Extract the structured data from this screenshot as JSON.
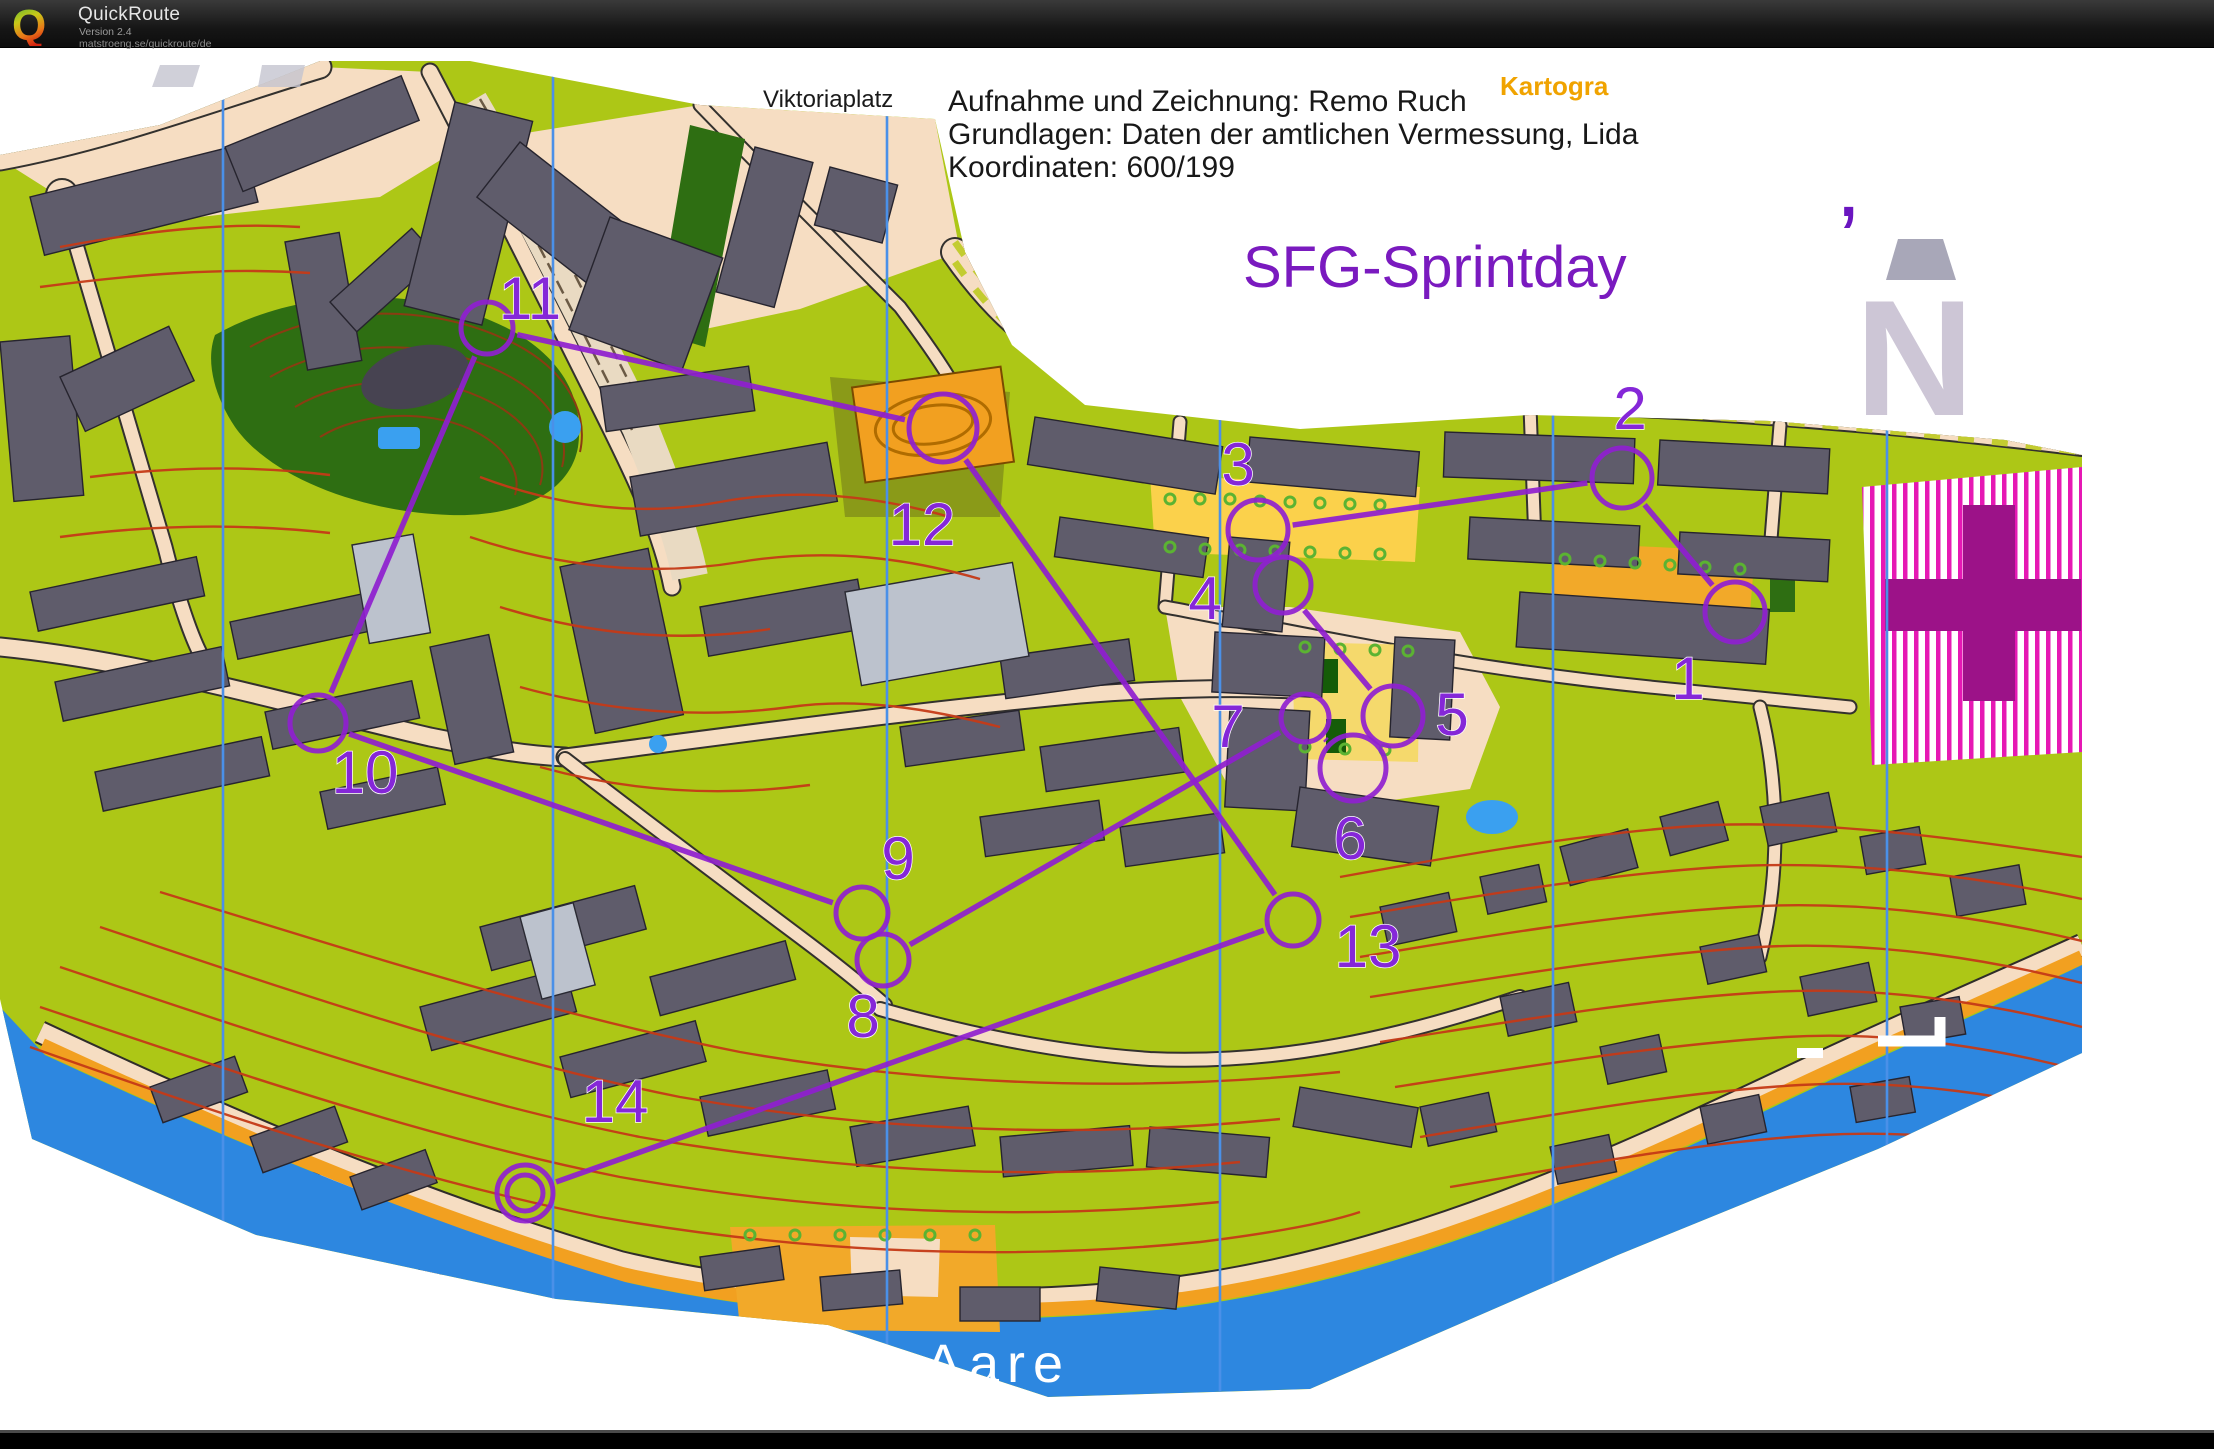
{
  "header": {
    "logo_letter": "Q",
    "app_name": "QuickRoute",
    "version": "Version 2.4",
    "url": "matstroeng.se/quickroute/de"
  },
  "map": {
    "labels": {
      "place": "Viktoriaplatz",
      "event_title": "SFG-Sprintday",
      "partial_text": "Kartogra",
      "river": "Aare",
      "north_mark": "N",
      "apostrophe": "’"
    },
    "credits": [
      "Aufnahme und Zeichnung: Remo Ruch",
      "Grundlagen: Daten der amtlichen Vermessung, Lida",
      "Koordinaten: 600/199"
    ],
    "course": {
      "color": "#8f1fd0",
      "number_color": "#8527d8",
      "controls": [
        {
          "n": "1",
          "cx": 1735,
          "cy": 565,
          "r": 30,
          "tx": 1688,
          "ty": 652
        },
        {
          "n": "2",
          "cx": 1622,
          "cy": 431,
          "r": 30,
          "tx": 1630,
          "ty": 382
        },
        {
          "n": "3",
          "cx": 1258,
          "cy": 483,
          "r": 30,
          "tx": 1238,
          "ty": 438
        },
        {
          "n": "4",
          "cx": 1283,
          "cy": 538,
          "r": 28,
          "tx": 1205,
          "ty": 572
        },
        {
          "n": "5",
          "cx": 1393,
          "cy": 669,
          "r": 30,
          "tx": 1452,
          "ty": 688
        },
        {
          "n": "6",
          "cx": 1353,
          "cy": 721,
          "r": 33,
          "tx": 1350,
          "ty": 812
        },
        {
          "n": "7",
          "cx": 1305,
          "cy": 671,
          "r": 24,
          "tx": 1228,
          "ty": 700
        },
        {
          "n": "8",
          "cx": 883,
          "cy": 913,
          "r": 26,
          "tx": 863,
          "ty": 990
        },
        {
          "n": "9",
          "cx": 862,
          "cy": 866,
          "r": 26,
          "tx": 898,
          "ty": 832
        },
        {
          "n": "10",
          "cx": 318,
          "cy": 676,
          "r": 28,
          "tx": 365,
          "ty": 746
        },
        {
          "n": "11",
          "cx": 487,
          "cy": 281,
          "r": 26,
          "tx": 530,
          "ty": 272
        },
        {
          "n": "12",
          "cx": 943,
          "cy": 381,
          "r": 34,
          "tx": 922,
          "ty": 498
        },
        {
          "n": "13",
          "cx": 1293,
          "cy": 873,
          "r": 26,
          "tx": 1368,
          "ty": 920
        },
        {
          "n": "14",
          "cx": 525,
          "cy": 1146,
          "r": 28,
          "double": true,
          "tx": 615,
          "ty": 1075
        }
      ],
      "legs": [
        [
          1,
          2
        ],
        [
          2,
          3
        ],
        [
          3,
          4
        ],
        [
          4,
          5
        ],
        [
          5,
          6
        ],
        [
          6,
          7
        ],
        [
          7,
          8
        ],
        [
          8,
          9
        ],
        [
          9,
          10
        ],
        [
          10,
          11
        ],
        [
          11,
          12
        ],
        [
          12,
          13
        ],
        [
          13,
          14
        ]
      ]
    },
    "north_lines_x": [
      223,
      553,
      887,
      1220,
      1553,
      1887
    ],
    "colors": {
      "paper": "#ffffff",
      "open_land": "#adc716",
      "road": "#f6ddc2",
      "building": "#5f5c6b",
      "forest": "#2e6e12",
      "water": "#2d87e0",
      "contour": "#c53a17",
      "oob_stripe": "#e618b4",
      "oob_cross": "#9c1288",
      "course": "#8f1fd0",
      "event_title_color": "#7a1abf",
      "partial_text_color": "#f0a300",
      "north_mark_color": "#cdc6d6"
    }
  }
}
